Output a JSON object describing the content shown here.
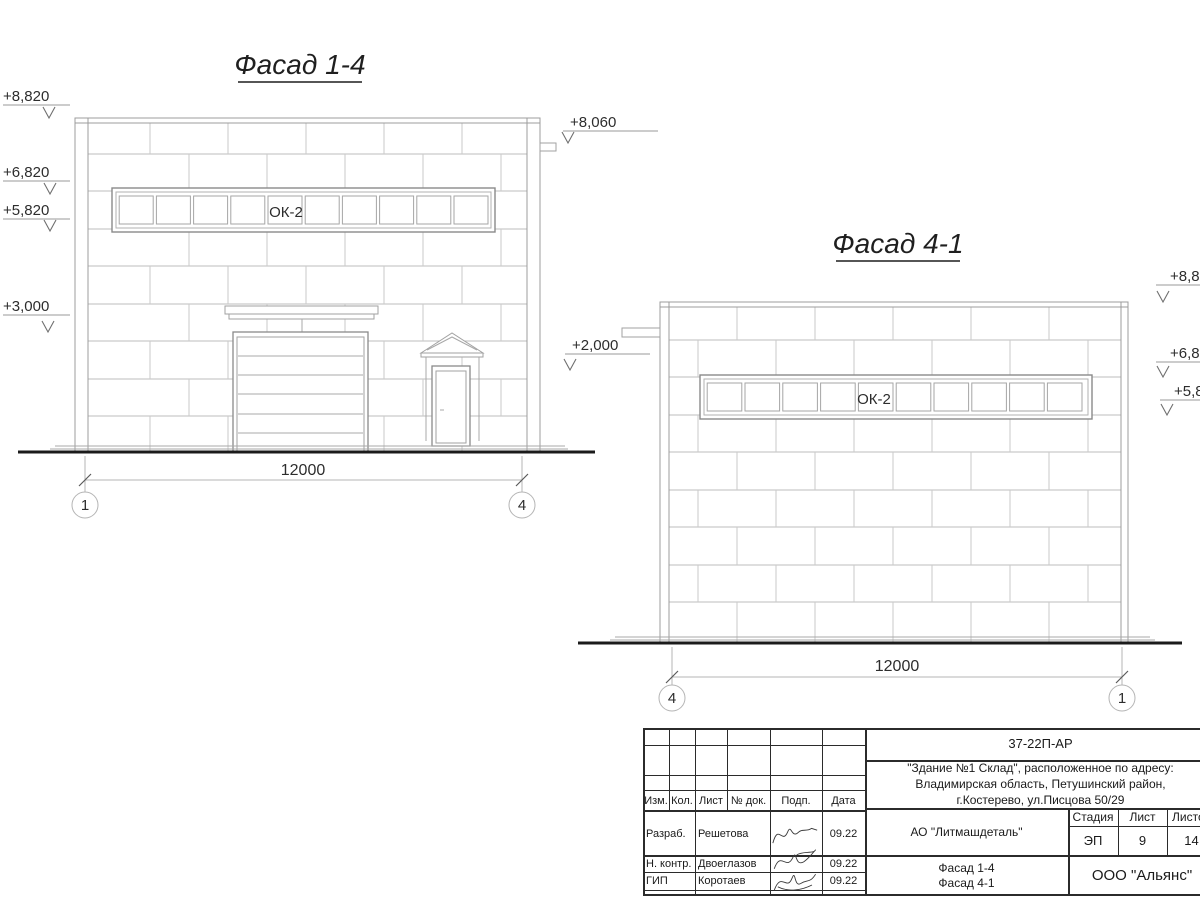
{
  "facade_1_4": {
    "title": "Фасад 1-4",
    "window_label": "ОК-2",
    "dimension": "12000",
    "axis_left": "1",
    "axis_right": "4",
    "elev_8820": "+8,820",
    "elev_6820": "+6,820",
    "elev_5820": "+5,820",
    "elev_3000": "+3,000",
    "elev_8060": "+8,060",
    "elev_2000": "+2,000"
  },
  "facade_4_1": {
    "title": "Фасад 4-1",
    "window_label": "ОК-2",
    "dimension": "12000",
    "axis_left": "4",
    "axis_right": "1",
    "elev_8820": "+8,820",
    "elev_6820": "+6,820",
    "elev_5820": "+5,820"
  },
  "titleblock": {
    "doc_number": "37-22П-АР",
    "address_line1": "\"Здание №1 Склад\", расположенное по адресу:",
    "address_line2": "Владимирская область, Петушинский район,",
    "address_line3": "г.Костерево, ул.Писцова 50/29",
    "col_izm": "Изм.",
    "col_kol": "Кол.",
    "col_list": "Лист",
    "col_doc": "№ док.",
    "col_podp": "Подп.",
    "col_data": "Дата",
    "row1_role": "Разраб.",
    "row1_name": "Решетова",
    "row1_date": "09.22",
    "row2_role": "Н. контр.",
    "row2_name": "Двоеглазов",
    "row2_date": "09.22",
    "row3_role": "ГИП",
    "row3_name": "Коротаев",
    "row3_date": "09.22",
    "company": "АО \"Литмашдеталь\"",
    "stage_label": "Стадия",
    "sheet_label": "Лист",
    "sheets_label": "Листов",
    "stage": "ЭП",
    "sheet": "9",
    "sheets": "14",
    "sheet_title_line1": "Фасад 1-4",
    "sheet_title_line2": "Фасад 4-1",
    "org": "ООО \"Альянс\""
  }
}
